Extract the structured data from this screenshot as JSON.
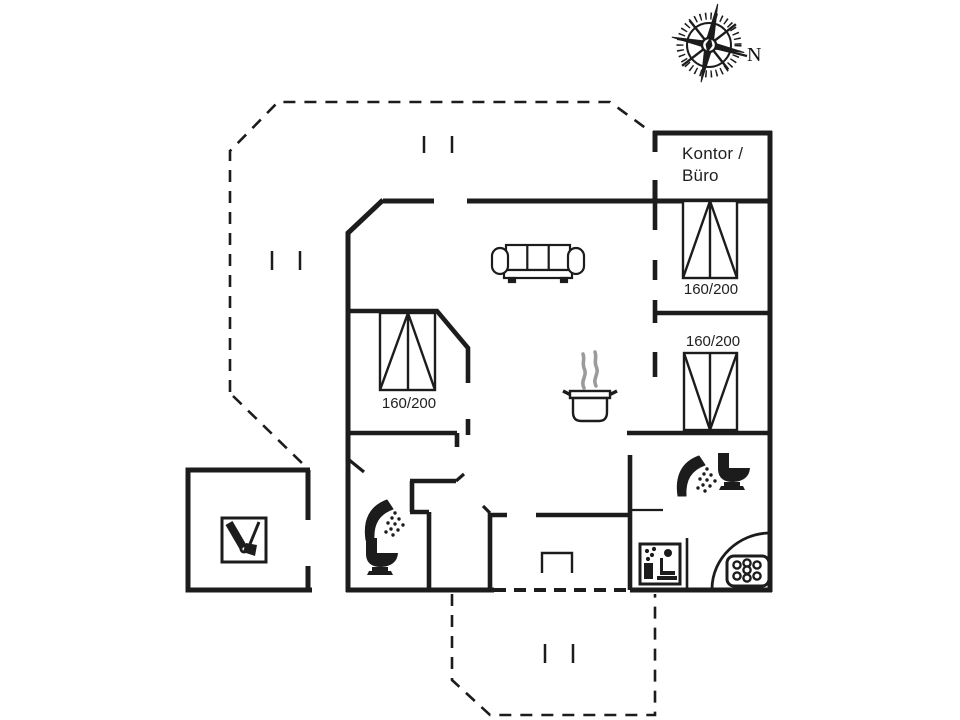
{
  "colors": {
    "background": "#ffffff",
    "ink": "#1c1c1c",
    "steam": "#9b9b9b"
  },
  "compass": {
    "label": "N",
    "icon": "compass-rose-icon"
  },
  "office": {
    "label_line1": "Kontor /",
    "label_line2": "Büro"
  },
  "beds": [
    {
      "size_label": "160/200"
    },
    {
      "size_label": "160/200"
    },
    {
      "size_label": "160/200"
    }
  ],
  "icons": {
    "sofa": "sofa-icon",
    "cooking_pot": "cooking-pot-icon",
    "shower": "shower-icon",
    "toilet": "toilet-icon",
    "garden_tools": "garden-tools-icon",
    "sauna": "sauna-icon",
    "whirlpool": "whirlpool-icon",
    "compass": "compass-rose-icon"
  }
}
